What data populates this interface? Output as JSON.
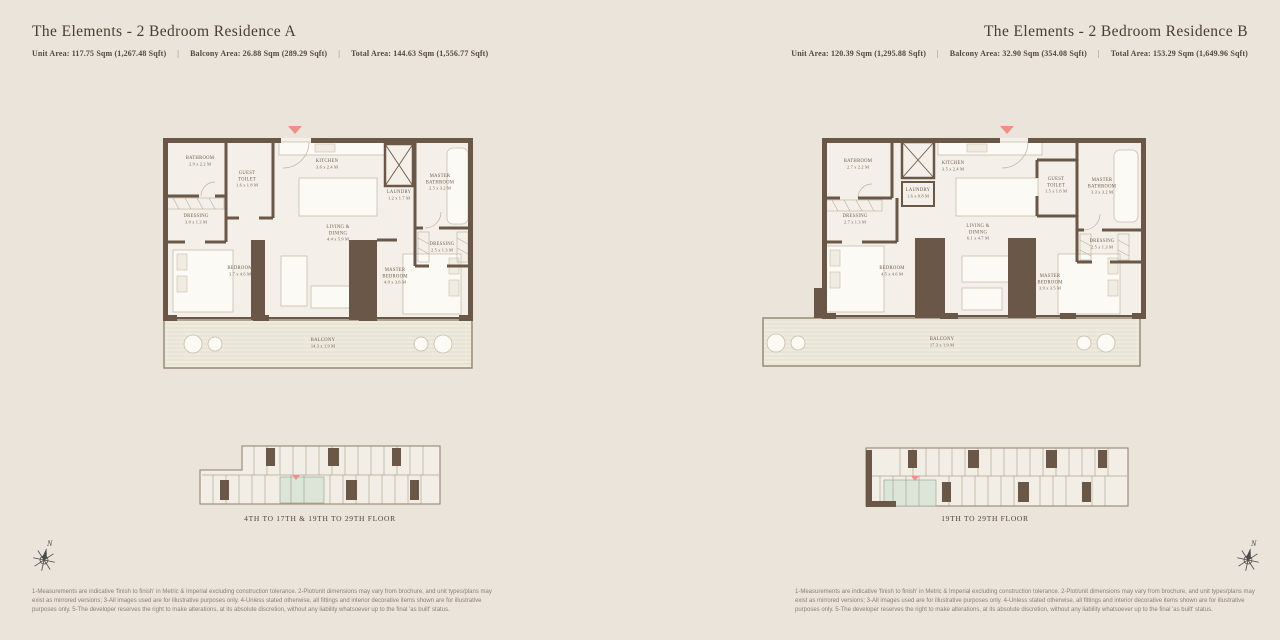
{
  "theme": {
    "background": "#eae4db",
    "wall_color": "#6a5748",
    "floor_color": "#f4f0e9",
    "balcony_floor_color": "#eeeade",
    "title_color": "#4a3c2f",
    "entry_arrow_color": "#ef8f88",
    "keyplan_highlight_color": "#dbe5d8",
    "disclaimer_color": "#8b8072"
  },
  "stats_separator": "|",
  "compass_label": "N",
  "residence_a": {
    "title": "The Elements - 2 Bedroom Residence A",
    "stats": [
      {
        "text": "Unit Area: 117.75 Sqm (1,267.48 Sqft)"
      },
      {
        "text": "Balcony Area: 26.88 Sqm (289.29 Sqft)"
      },
      {
        "text": "Total Area: 144.63 Sqm (1,556.77 Sqft)"
      }
    ],
    "rooms": {
      "bathroom": {
        "name": "BATHROOM",
        "dims": "2.9 x 2.2 M"
      },
      "guest_toilet": {
        "name": "GUEST TOILET",
        "dims": "1.6 x 1.8 M"
      },
      "kitchen": {
        "name": "KITCHEN",
        "dims": "3.6 x 2.4 M"
      },
      "laundry": {
        "name": "LAUNDRY",
        "dims": "1.2 x 1.7 M"
      },
      "master_bathroom": {
        "name": "MASTER BATHROOM",
        "dims": "2.5 x 3.2 M"
      },
      "dressing_1": {
        "name": "DRESSING",
        "dims": "3.0 x 1.3 M"
      },
      "living_dining": {
        "name": "LIVING & DINING",
        "dims": "4.4 x 5.9 M"
      },
      "dressing_2": {
        "name": "DRESSING",
        "dims": "2.5 x 1.3 M"
      },
      "bedroom": {
        "name": "BEDROOM",
        "dims": "3.7 x 4.6 M"
      },
      "master_bedroom": {
        "name": "MASTER BEDROOM",
        "dims": "4.0 x 3.6 M"
      },
      "balcony": {
        "name": "BALCONY",
        "dims": "14.3 x 1.9 M"
      }
    },
    "keyplan_caption": "4TH TO 17TH & 19TH TO 29TH FLOOR"
  },
  "residence_b": {
    "title": "The Elements - 2 Bedroom Residence B",
    "stats": [
      {
        "text": "Unit Area: 120.39 Sqm (1,295.88 Sqft)"
      },
      {
        "text": "Balcony Area: 32.90 Sqm (354.08 Sqft)"
      },
      {
        "text": "Total Area: 153.29 Sqm (1,649.96 Sqft)"
      }
    ],
    "rooms": {
      "bathroom": {
        "name": "BATHROOM",
        "dims": "2.7 x 2.2 M"
      },
      "laundry": {
        "name": "LAUNDRY",
        "dims": "1.6 x 0.8 M"
      },
      "kitchen": {
        "name": "KITCHEN",
        "dims": "3.5 x 2.4 M"
      },
      "guest_toilet": {
        "name": "GUEST TOILET",
        "dims": "1.5 x 1.6 M"
      },
      "master_bathroom": {
        "name": "MASTER BATHROOM",
        "dims": "3.3 x 3.2 M"
      },
      "dressing_1": {
        "name": "DRESSING",
        "dims": "2.7 x 1.3 M"
      },
      "living_dining": {
        "name": "LIVING & DINING",
        "dims": "6.1 x 4.7 M"
      },
      "dressing_2": {
        "name": "DRESSING",
        "dims": "2.5 x 1.3 M"
      },
      "bedroom": {
        "name": "BEDROOM",
        "dims": "4.5 x 4.6 M"
      },
      "master_bedroom": {
        "name": "MASTER BEDROOM",
        "dims": "3.9 x 3.5 M"
      },
      "balcony": {
        "name": "BALCONY",
        "dims": "17.3 x 1.9 M"
      }
    },
    "keyplan_caption": "19TH TO 29TH FLOOR"
  },
  "footer": {
    "disclaimer": "1-Measurements are indicative 'finish to finish' in Metric & Imperial excluding construction tolerance. 2-Plot/unit dimensions may vary from brochure, and unit types/plans may exist as mirrored versions; 3-All images used are for illustrative purposes only. 4-Unless stated otherwise, all fittings and interior decorative items shown are for illustrative purposes only. 5-The developer reserves the right to make alterations, at its absolute discretion, without any liability whatsoever up to the final 'as built' status."
  }
}
